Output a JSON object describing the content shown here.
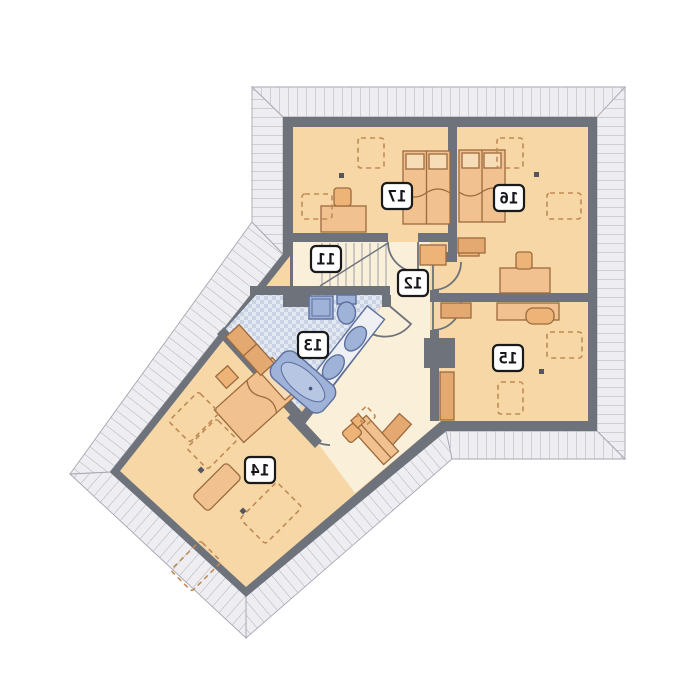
{
  "plan": {
    "description": "Attic storey architectural floor plan, mirrored print, rooms numbered 11-17",
    "rooms": [
      {
        "number": "11"
      },
      {
        "number": "12"
      },
      {
        "number": "13"
      },
      {
        "number": "14"
      },
      {
        "number": "15"
      },
      {
        "number": "16"
      },
      {
        "number": "17"
      }
    ],
    "colors": {
      "room_fill": "#f6d7a5",
      "hall_fill": "#faf0da",
      "bath_tile": "#dfe5ee",
      "wall": "#6d727b",
      "furniture": "#f1c190",
      "furniture_outline": "#9c6b3f",
      "fixture_blue": "#9fb2d8",
      "fixture_outline": "#5d6f9e",
      "eaves_fill": "#eeeef2",
      "eaves_tick": "#aeafb9",
      "dashed_outline": "#c08a55",
      "label_box": "#ffffff",
      "label_border": "#1a1a1a"
    }
  }
}
